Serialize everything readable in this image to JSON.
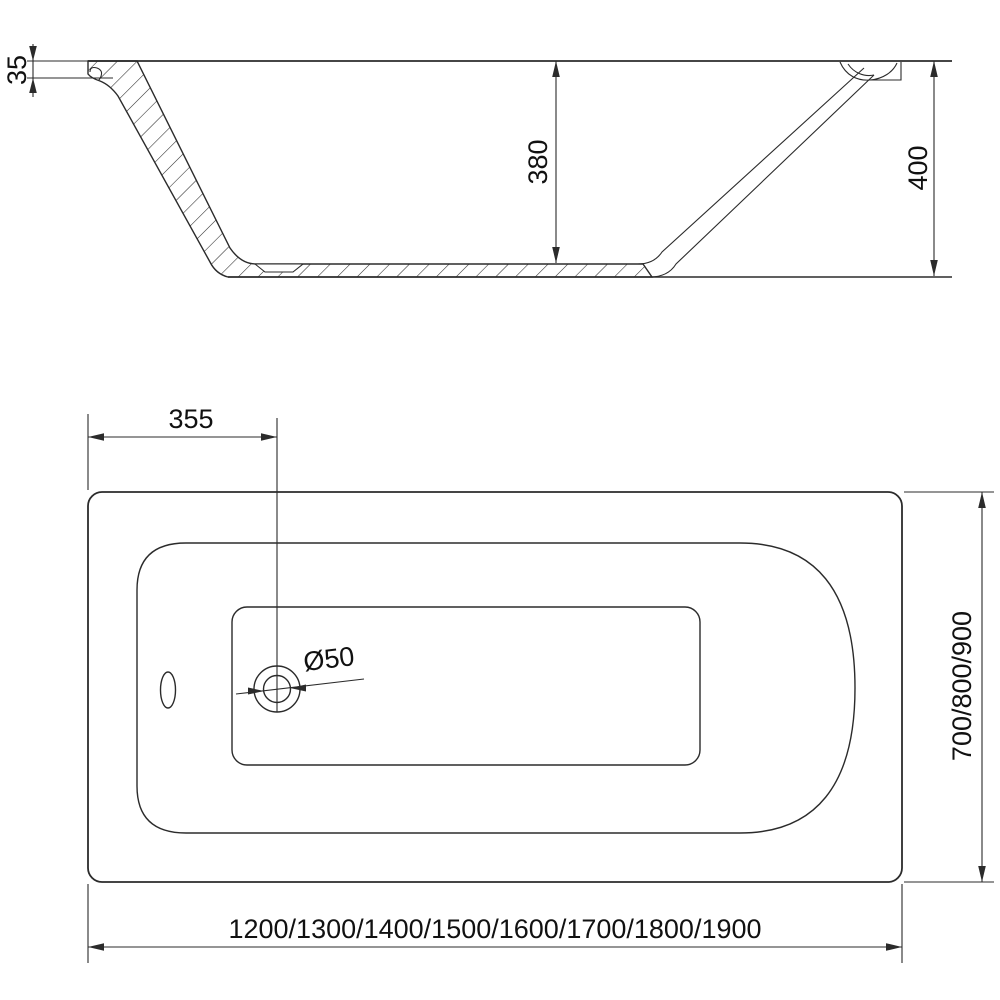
{
  "page": {
    "background": "#ffffff",
    "line_color": "#2b2b2b",
    "text_color": "#111111"
  },
  "section_view": {
    "dims": {
      "rim_thickness": "35",
      "inner_depth": "380",
      "overall_height": "400"
    }
  },
  "plan_view": {
    "dims": {
      "drain_center_offset": "355",
      "drain_diameter": "Ø50",
      "length_options": "1200/1300/1400/1500/1600/1700/1800/1900",
      "width_options": "700/800/900"
    }
  }
}
